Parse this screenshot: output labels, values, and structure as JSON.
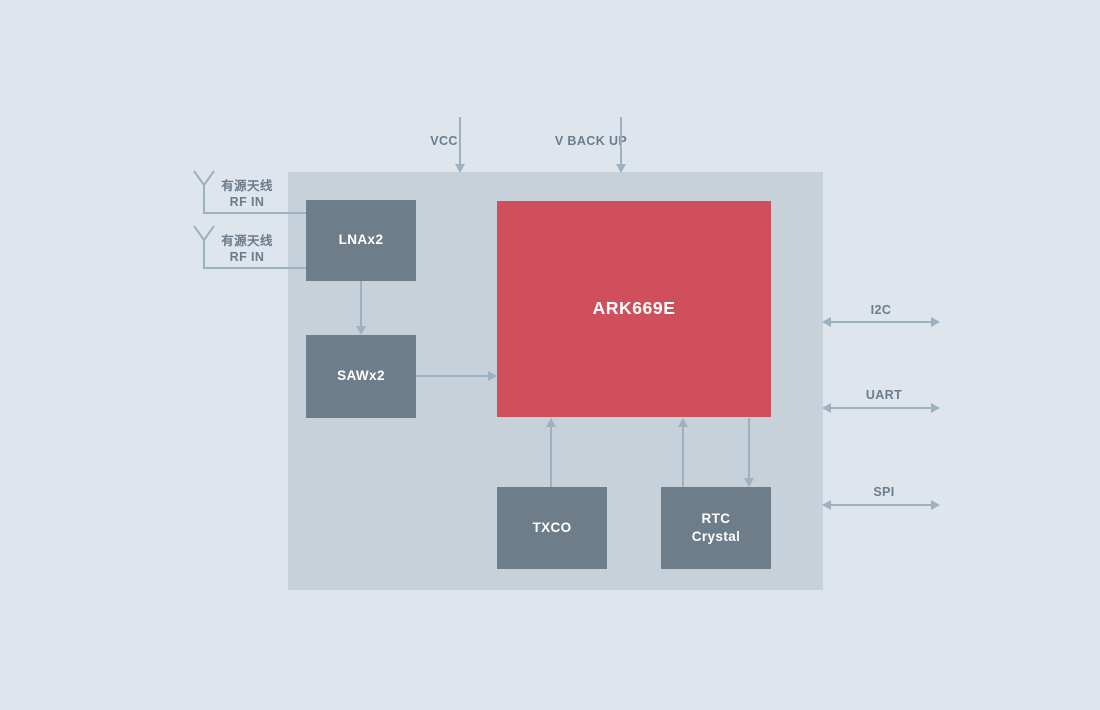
{
  "device": {
    "model": "ARK669E"
  },
  "power": {
    "vcc": "VCC",
    "vbackup": "V BACK UP"
  },
  "antennas": [
    {
      "name_cn": "有源天线",
      "rf": "RF IN"
    },
    {
      "name_cn": "有源天线",
      "rf": "RF IN"
    }
  ],
  "blocks": {
    "lna": "LNAx2",
    "saw": "SAWx2",
    "main": "ARK669E",
    "txco": "TXCO",
    "rtc": "RTC\nCrystal"
  },
  "interfaces": {
    "i2c": "I2C",
    "uart": "UART",
    "spi": "SPI"
  },
  "colors": {
    "background": "#dfe5ec",
    "panel": "#c7d1da",
    "block": "#6e7d8a",
    "main_block": "#d04f5c",
    "line": "#9db1c1",
    "label_text": "#6b7c8c"
  }
}
